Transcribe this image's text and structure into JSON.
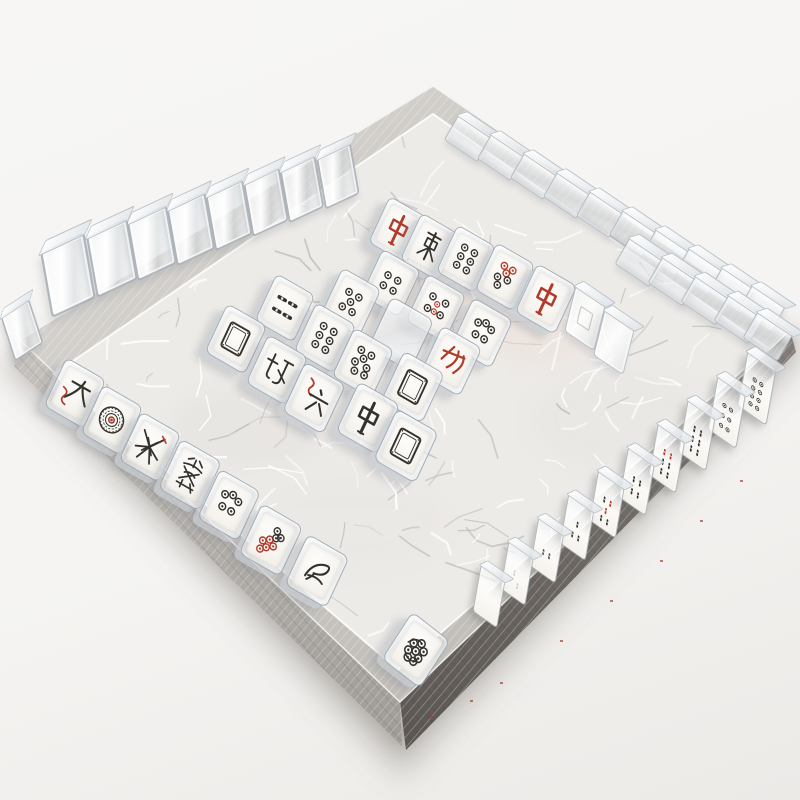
{
  "scene": {
    "subject": "acrylic mahjong tiles arranged on a square silver woven tray",
    "background_color": "#f6f5f3"
  },
  "palette": {
    "ink": "#35322d",
    "red": "#b23a28",
    "red_tile": "#bc3a26",
    "rim_silver": "#c9c6c1",
    "skirt_light": "#b3afaa",
    "skirt_dark": "#746e69",
    "floor": "#edebe8",
    "acrylic_edge": "#a9b0b5"
  },
  "tray": {
    "outer": [
      [
        433,
        86
      ],
      [
        790,
        330
      ],
      [
        400,
        702
      ],
      [
        20,
        340
      ]
    ],
    "floor": [
      [
        433,
        114
      ],
      [
        768,
        348
      ],
      [
        398,
        670
      ],
      [
        54,
        374
      ]
    ],
    "skirt_left": [
      [
        20,
        340
      ],
      [
        400,
        702
      ],
      [
        402,
        746
      ],
      [
        14,
        366
      ]
    ],
    "skirt_right": [
      [
        400,
        702
      ],
      [
        790,
        330
      ],
      [
        796,
        352
      ],
      [
        406,
        750
      ]
    ]
  },
  "tiles": [
    {
      "n": "wall-corner-tile",
      "s": "clear",
      "k": "wall",
      "x": 22,
      "y": 330,
      "r": -8,
      "sc": 0.78
    },
    {
      "n": "wall-tile-1",
      "s": "clear",
      "k": "wall",
      "x": 68,
      "y": 275,
      "sc": 1.12
    },
    {
      "n": "wall-tile-2",
      "s": "clear",
      "k": "wall",
      "x": 112,
      "y": 258,
      "sc": 1.04
    },
    {
      "n": "wall-tile-3",
      "s": "clear",
      "k": "wall",
      "x": 152,
      "y": 243
    },
    {
      "n": "wall-tile-4",
      "s": "clear",
      "k": "wall",
      "x": 191,
      "y": 229,
      "sc": 0.97
    },
    {
      "n": "wall-tile-5",
      "s": "clear",
      "k": "wall",
      "x": 229,
      "y": 215,
      "sc": 0.94
    },
    {
      "n": "wall-tile-6",
      "s": "clear",
      "k": "wall",
      "x": 266,
      "y": 202,
      "sc": 0.91
    },
    {
      "n": "wall-tile-7",
      "s": "clear",
      "k": "wall",
      "x": 302,
      "y": 189,
      "sc": 0.89
    },
    {
      "n": "wall-tile-8",
      "s": "clear",
      "k": "wall",
      "x": 338,
      "y": 176,
      "sc": 0.87
    },
    {
      "n": "block-tile-1",
      "s": "clear",
      "k": "block",
      "x": 468,
      "y": 138
    },
    {
      "n": "block-tile-2",
      "s": "clear",
      "k": "block",
      "x": 501,
      "y": 157
    },
    {
      "n": "block-tile-3",
      "s": "clear",
      "k": "block",
      "x": 534,
      "y": 176
    },
    {
      "n": "block-tile-4",
      "s": "clear",
      "k": "block",
      "x": 567,
      "y": 195
    },
    {
      "n": "block-tile-5",
      "s": "clear",
      "k": "block",
      "x": 600,
      "y": 214
    },
    {
      "n": "block-tile-6",
      "s": "clear",
      "k": "block",
      "x": 633,
      "y": 233
    },
    {
      "n": "block-tile-7",
      "s": "clear",
      "k": "block",
      "x": 666,
      "y": 252
    },
    {
      "n": "block-tile-8",
      "s": "clear",
      "k": "block",
      "x": 699,
      "y": 271
    },
    {
      "n": "block-tile-9",
      "s": "clear",
      "k": "block",
      "x": 732,
      "y": 290
    },
    {
      "n": "block-tile-10",
      "s": "clear",
      "k": "block",
      "x": 762,
      "y": 308
    },
    {
      "n": "block-tile-11",
      "s": "clear",
      "k": "block",
      "x": 640,
      "y": 262,
      "sc": 1.06
    },
    {
      "n": "block-tile-12",
      "s": "clear",
      "k": "block",
      "x": 673,
      "y": 281,
      "sc": 1.06
    },
    {
      "n": "block-tile-13",
      "s": "clear",
      "k": "block",
      "x": 706,
      "y": 300,
      "sc": 1.06
    },
    {
      "n": "block-tile-14",
      "s": "clear",
      "k": "block",
      "x": 739,
      "y": 319,
      "sc": 1.06
    },
    {
      "n": "block-tile-15",
      "s": "clear",
      "k": "block",
      "x": 768,
      "y": 336,
      "sc": 1.06
    },
    {
      "n": "tile-red-dragon-1",
      "s": "zhong-red",
      "k": "flat",
      "x": 398,
      "y": 230,
      "sc": 0.95,
      "g": "中",
      "label": "red dragon"
    },
    {
      "n": "tile-character-east",
      "s": "east-char",
      "k": "flat",
      "x": 430,
      "y": 247,
      "sc": 0.96,
      "label": "character tile"
    },
    {
      "n": "tile-dots-6-a",
      "s": "dots-6",
      "k": "flat",
      "x": 466,
      "y": 259,
      "sc": 0.96,
      "label": "six dots"
    },
    {
      "n": "tile-dots-red-top",
      "s": "dots-red-top",
      "k": "flat",
      "x": 505,
      "y": 277,
      "sc": 0.97,
      "label": "red and black dots"
    },
    {
      "n": "tile-red-dragon-2",
      "s": "zhong-red",
      "k": "flat",
      "x": 546,
      "y": 299,
      "g": "中",
      "label": "red dragon"
    },
    {
      "n": "tile-bamboo-side",
      "s": "bamboo-side",
      "k": "flat",
      "x": 285,
      "y": 308,
      "sc": 0.97,
      "label": "bamboo sticks"
    },
    {
      "n": "tile-dots-5-a",
      "s": "dots-5",
      "k": "flat",
      "x": 351,
      "y": 302,
      "sc": 0.97,
      "label": "five dots"
    },
    {
      "n": "tile-dots-4-a",
      "s": "dots-4",
      "k": "flat",
      "x": 391,
      "y": 283,
      "sc": 0.96,
      "label": "four dots"
    },
    {
      "n": "tile-white-dragon-1",
      "s": "white-dragon",
      "k": "flat",
      "x": 236,
      "y": 339,
      "label": "white dragon"
    },
    {
      "n": "tile-dots-6-b",
      "s": "dots-6",
      "k": "flat",
      "x": 325,
      "y": 338,
      "label": "six dots"
    },
    {
      "n": "tile-red-blank",
      "s": "red-square",
      "k": "flat",
      "x": 401,
      "y": 334,
      "sc": 1.06,
      "label": "red lacquer tile"
    },
    {
      "n": "tile-dots-mixed",
      "s": "dots-mixed",
      "k": "flat",
      "x": 436,
      "y": 308,
      "sc": 0.97,
      "label": "mixed dots"
    },
    {
      "n": "tile-dots-5-b",
      "s": "dots-5b",
      "k": "flat",
      "x": 482,
      "y": 333,
      "label": "five dots"
    },
    {
      "n": "tile-character-north",
      "s": "north-char",
      "k": "flat",
      "x": 277,
      "y": 370,
      "label": "character tile"
    },
    {
      "n": "tile-six-wan",
      "s": "six-wan",
      "k": "flat",
      "x": 314,
      "y": 398,
      "sc": 1.02,
      "g": "六",
      "label": "six character"
    },
    {
      "n": "tile-dots-7",
      "s": "dots-7",
      "k": "flat",
      "x": 363,
      "y": 363,
      "label": "seven dots"
    },
    {
      "n": "tile-red-bamboo-char",
      "s": "red-claw",
      "k": "flat",
      "x": 451,
      "y": 361,
      "label": "red character"
    },
    {
      "n": "tile-black-zhong",
      "s": "zhong-black",
      "k": "flat",
      "x": 368,
      "y": 418,
      "sc": 1.03,
      "g": "中",
      "label": "black center character"
    },
    {
      "n": "tile-white-dragon-2",
      "s": "white-dragon",
      "k": "flat",
      "x": 413,
      "y": 387,
      "sc": 1.02,
      "label": "white dragon"
    },
    {
      "n": "tile-white-dragon-3",
      "s": "white-dragon",
      "k": "flat",
      "x": 406,
      "y": 446,
      "sc": 1.05,
      "label": "white dragon"
    },
    {
      "n": "tile-da-wan",
      "s": "da-wan",
      "k": "flat",
      "x": 75,
      "y": 393,
      "g": "大",
      "label": "wan character"
    },
    {
      "n": "tile-one-dot",
      "s": "one-dot",
      "k": "flat",
      "x": 112,
      "y": 420,
      "label": "one dot"
    },
    {
      "n": "tile-spark-char",
      "s": "spark-char",
      "k": "flat",
      "x": 150,
      "y": 447,
      "label": "character tile"
    },
    {
      "n": "tile-fa",
      "s": "fa-char",
      "k": "flat",
      "x": 190,
      "y": 475,
      "sc": 1.02,
      "g": "發",
      "label": "green dragon"
    },
    {
      "n": "tile-dots-5-c",
      "s": "dots-5b",
      "k": "flat",
      "x": 229,
      "y": 505,
      "sc": 1.02,
      "label": "five dots"
    },
    {
      "n": "tile-dots-red-cluster",
      "s": "dots-red-cluster",
      "k": "flat",
      "x": 271,
      "y": 540,
      "sc": 1.03,
      "label": "red and black dots"
    },
    {
      "n": "tile-bird-char",
      "s": "bird-char",
      "k": "flat",
      "x": 317,
      "y": 571,
      "sc": 1.04,
      "label": "bird character"
    },
    {
      "n": "tile-scribble",
      "s": "scribble-dots",
      "k": "flat",
      "x": 416,
      "y": 650,
      "r": 8,
      "sc": 1.05,
      "label": "scribbled dots"
    },
    {
      "n": "rail-tile-dots-8",
      "s": "rail-dots-8",
      "k": "rail",
      "x": 757,
      "y": 388,
      "sc": 1.06
    },
    {
      "n": "rail-tile-dots-6",
      "s": "rail-dots-6",
      "k": "rail",
      "x": 727,
      "y": 412,
      "sc": 1.04
    },
    {
      "n": "rail-tile-bamboo-1",
      "s": "rail-bamboo-6",
      "k": "rail",
      "x": 697,
      "y": 435,
      "sc": 1.02
    },
    {
      "n": "rail-tile-bamboo-red",
      "s": "rail-bamboo-red",
      "k": "rail",
      "x": 667,
      "y": 458
    },
    {
      "n": "rail-tile-bamboo-2",
      "s": "rail-bamboo-4",
      "k": "rail",
      "x": 637,
      "y": 481,
      "sc": 0.98
    },
    {
      "n": "rail-tile-bamboo-mixed",
      "s": "rail-bamboo-mixed",
      "k": "rail",
      "x": 607,
      "y": 504,
      "sc": 0.97
    },
    {
      "n": "rail-tile-bamboo-3",
      "s": "rail-bamboo-3",
      "k": "rail",
      "x": 577,
      "y": 527,
      "sc": 0.95
    },
    {
      "n": "rail-tile-bamboo-4",
      "s": "rail-bamboo-2",
      "k": "rail",
      "x": 547,
      "y": 550,
      "sc": 0.94
    },
    {
      "n": "rail-tile-faint",
      "s": "rail-faint",
      "k": "rail",
      "x": 517,
      "y": 573,
      "sc": 0.92
    },
    {
      "n": "rail-tile-clear",
      "s": "clear",
      "k": "rail",
      "x": 489,
      "y": 596,
      "sc": 0.9
    },
    {
      "n": "tile-clear-frame",
      "s": "faint-frame",
      "k": "clearflat",
      "x": 585,
      "y": 318
    },
    {
      "n": "tile-clear-flat",
      "s": "clear",
      "k": "clearflat",
      "x": 614,
      "y": 342
    }
  ]
}
